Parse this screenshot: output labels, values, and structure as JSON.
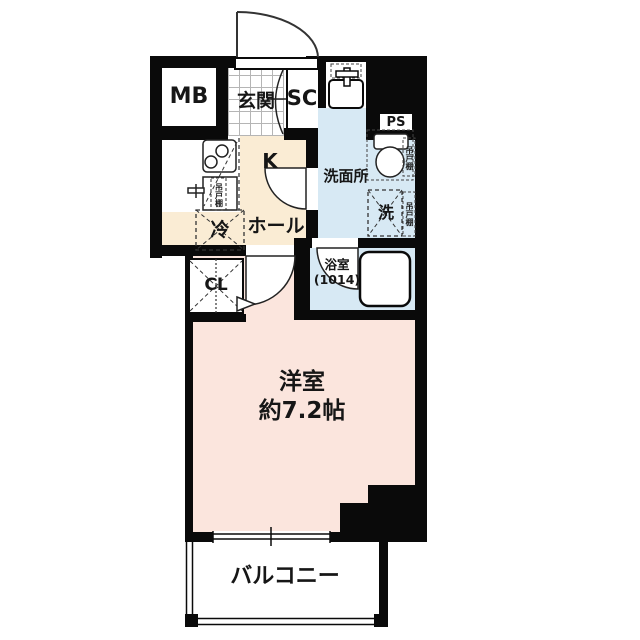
{
  "title": "apartment-floor-plan",
  "colors": {
    "wall": "#0a0a0a",
    "main_room": "#fbe5dd",
    "hall": "#faecd4",
    "wet_area": "#d7e9f4",
    "tile_grid": "#b5b5b5"
  },
  "rooms": {
    "meter_box": "MB",
    "entrance": "玄関",
    "shoe_closet": "SC",
    "pipe_space": "PS",
    "kitchen": "K",
    "hall": "ホール",
    "fridge": "冷",
    "closet": "CL",
    "washroom": "洗面所",
    "washer": "洗",
    "hanging_cupboard": "吊戸棚",
    "bathroom_name": "浴室",
    "bathroom_size": "(1014)",
    "main_room_name": "洋室",
    "main_room_size": "約7.2帖",
    "balcony": "バルコニー"
  }
}
